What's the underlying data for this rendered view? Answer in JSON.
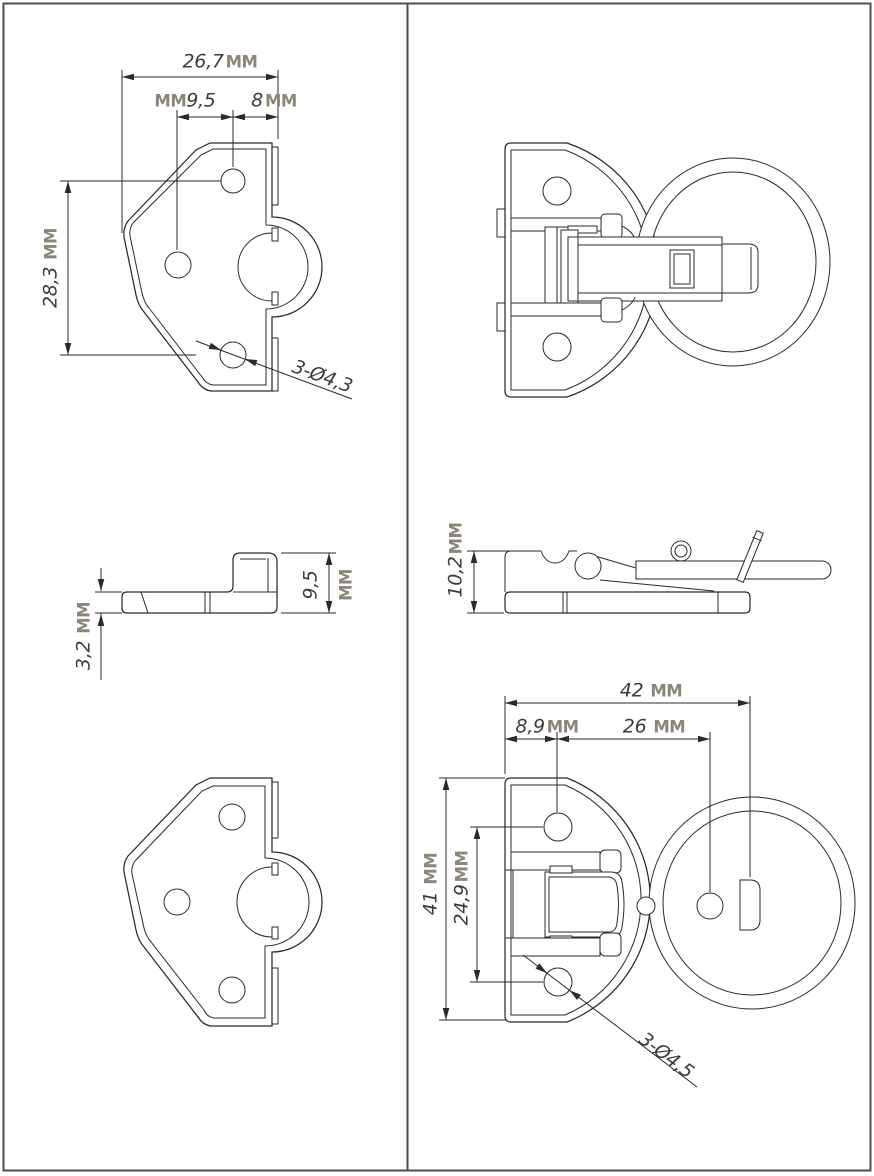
{
  "colors": {
    "line": "#2a2a2a",
    "frame": "#4d4d4d",
    "number_text": "#3c3c3c",
    "unit_text": "#8b8677",
    "background": "#ffffff"
  },
  "dimensions": {
    "plate_front": {
      "width": {
        "num": "26,7",
        "unit": "MM"
      },
      "hole_offset_a": {
        "num": "9,5",
        "unit": "MM"
      },
      "hole_offset_b": {
        "num": "8",
        "unit": "MM"
      },
      "height": {
        "num": "28,3",
        "unit": "MM"
      },
      "holes_callout": {
        "num": "3-Ø4,3"
      }
    },
    "plate_side": {
      "thickness": {
        "num": "3,2",
        "unit": "MM"
      },
      "hook_height": {
        "num": "9,5",
        "unit": "MM"
      }
    },
    "latch_side": {
      "height": {
        "num": "10,2",
        "unit": "MM"
      }
    },
    "latch_front": {
      "width": {
        "num": "42",
        "unit": "MM"
      },
      "hole_offset_a": {
        "num": "8,9",
        "unit": "MM"
      },
      "hole_spacing": {
        "num": "26",
        "unit": "MM"
      },
      "height": {
        "num": "41",
        "unit": "MM"
      },
      "hole_vspacing": {
        "num": "24,9",
        "unit": "MM"
      },
      "holes_callout": {
        "num": "3-Ø4,5"
      }
    }
  }
}
